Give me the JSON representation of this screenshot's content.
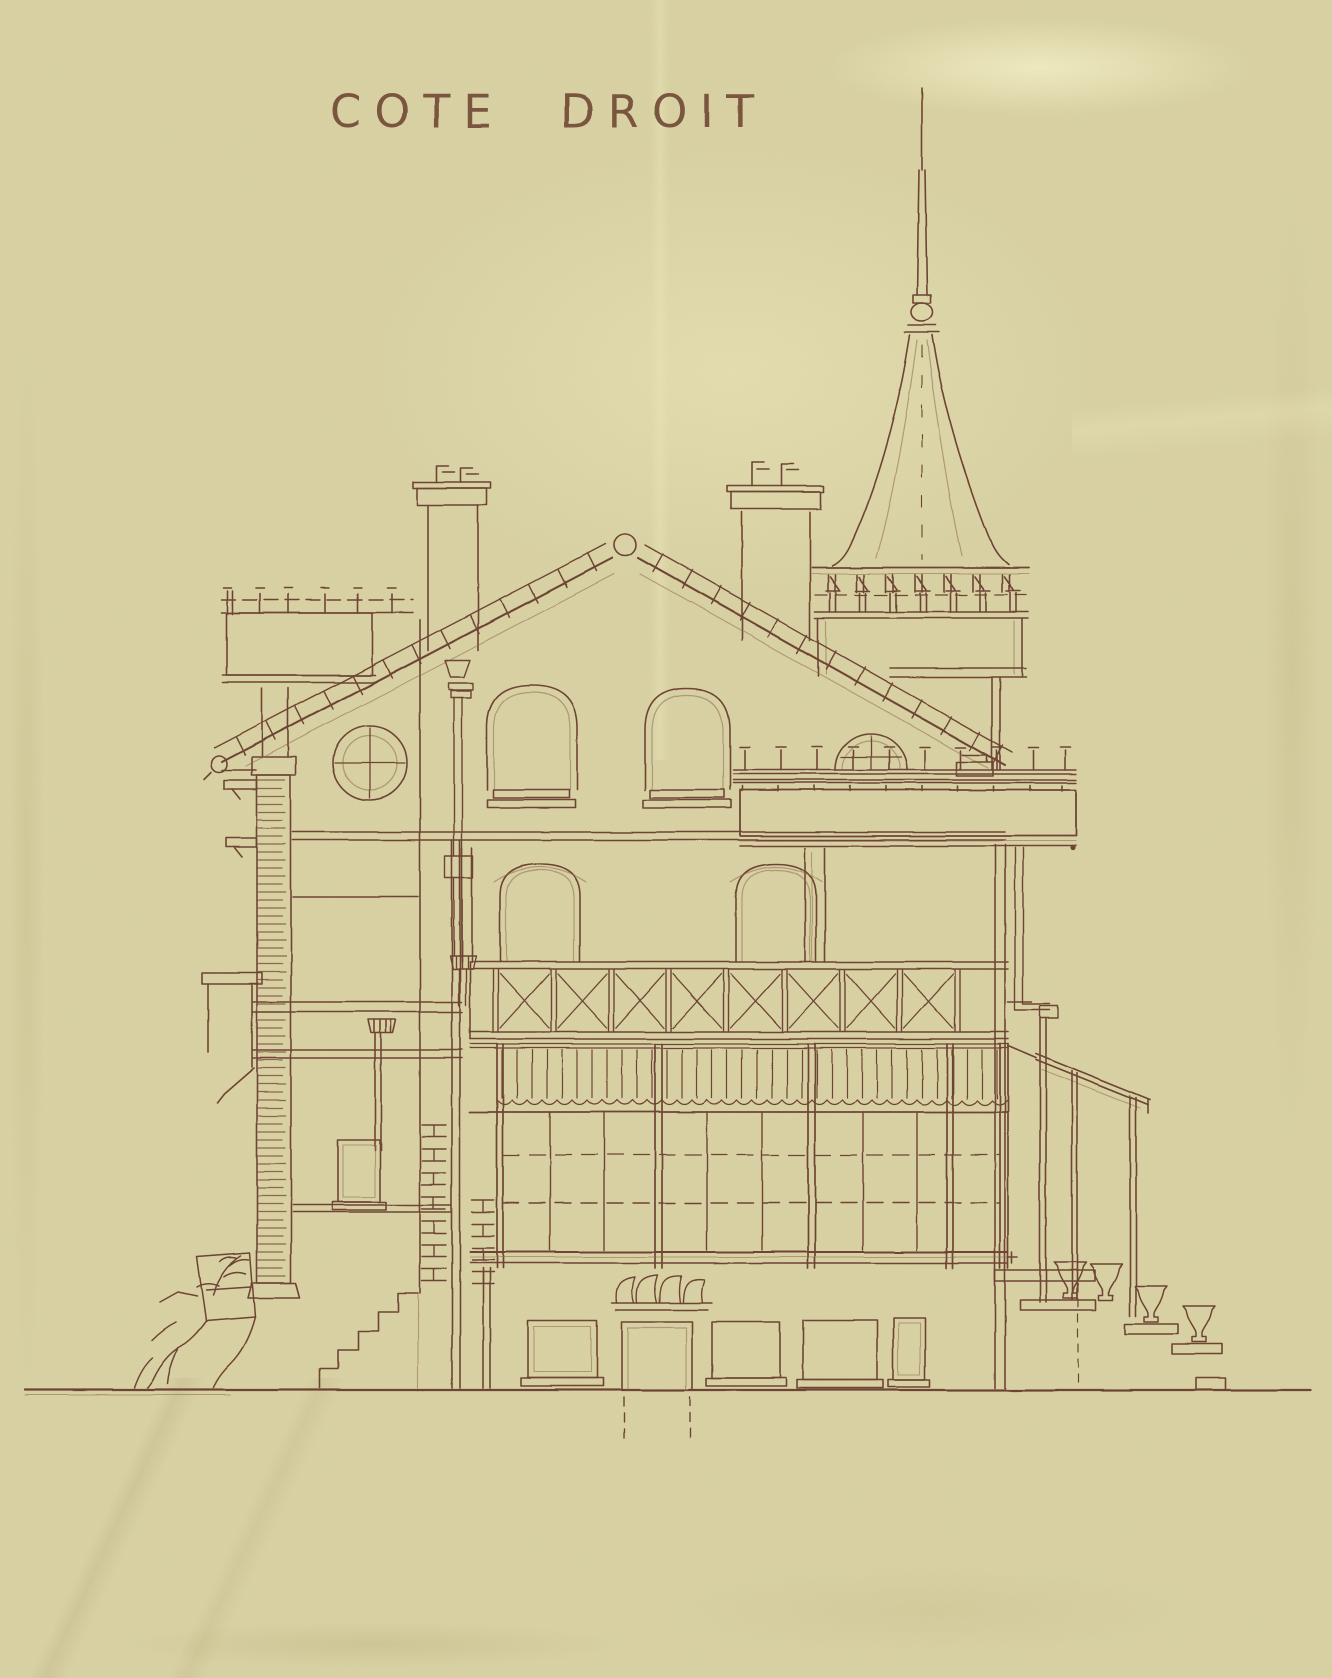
{
  "page": {
    "title": "COTE DROIT",
    "colors": {
      "paper": "#d9d2a4",
      "ink": "#6e4434",
      "ink_faint": "#8e6a50",
      "backdrop": "#b7af88"
    }
  }
}
